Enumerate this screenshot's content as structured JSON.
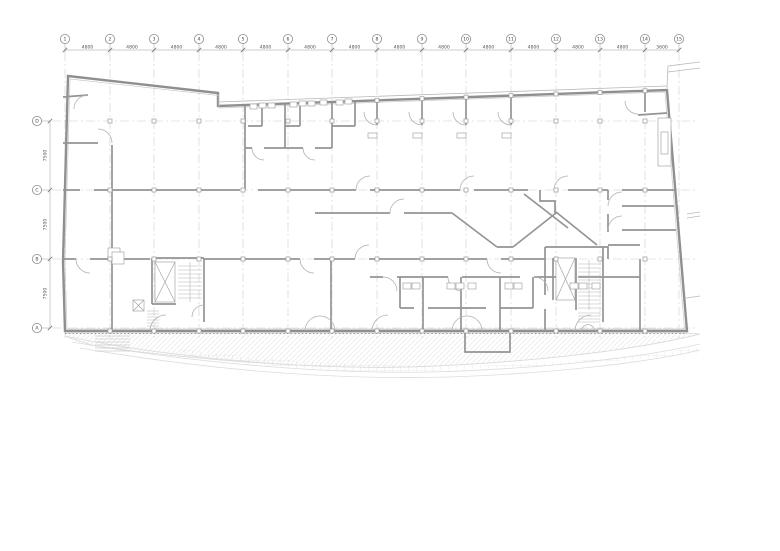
{
  "plan": {
    "top_axis": {
      "bubble_labels": [
        "1",
        "2",
        "3",
        "4",
        "5",
        "6",
        "7",
        "8",
        "9",
        "10",
        "11",
        "12",
        "13",
        "14",
        "15"
      ],
      "positions": [
        65,
        110,
        154,
        199,
        243,
        288,
        332,
        377,
        422,
        466,
        511,
        556,
        600,
        645,
        679
      ],
      "span_dims": [
        "4800",
        "4800",
        "4800",
        "4800",
        "4800",
        "4800",
        "4800",
        "4800",
        "4800",
        "4800",
        "4800",
        "4800",
        "4800",
        "3600"
      ]
    },
    "left_axis": {
      "bubble_labels": [
        "D",
        "C",
        "B",
        "A"
      ],
      "positions": [
        121,
        190,
        259,
        328
      ],
      "span_dims": [
        "7500",
        "7500",
        "7500"
      ]
    },
    "colors": {
      "wall": "#8f8f8f",
      "wall_light": "#b3b3b3",
      "grid": "#c8c8c8",
      "hatch": "#dedede",
      "text": "#555555",
      "paper": "#ffffff"
    }
  }
}
